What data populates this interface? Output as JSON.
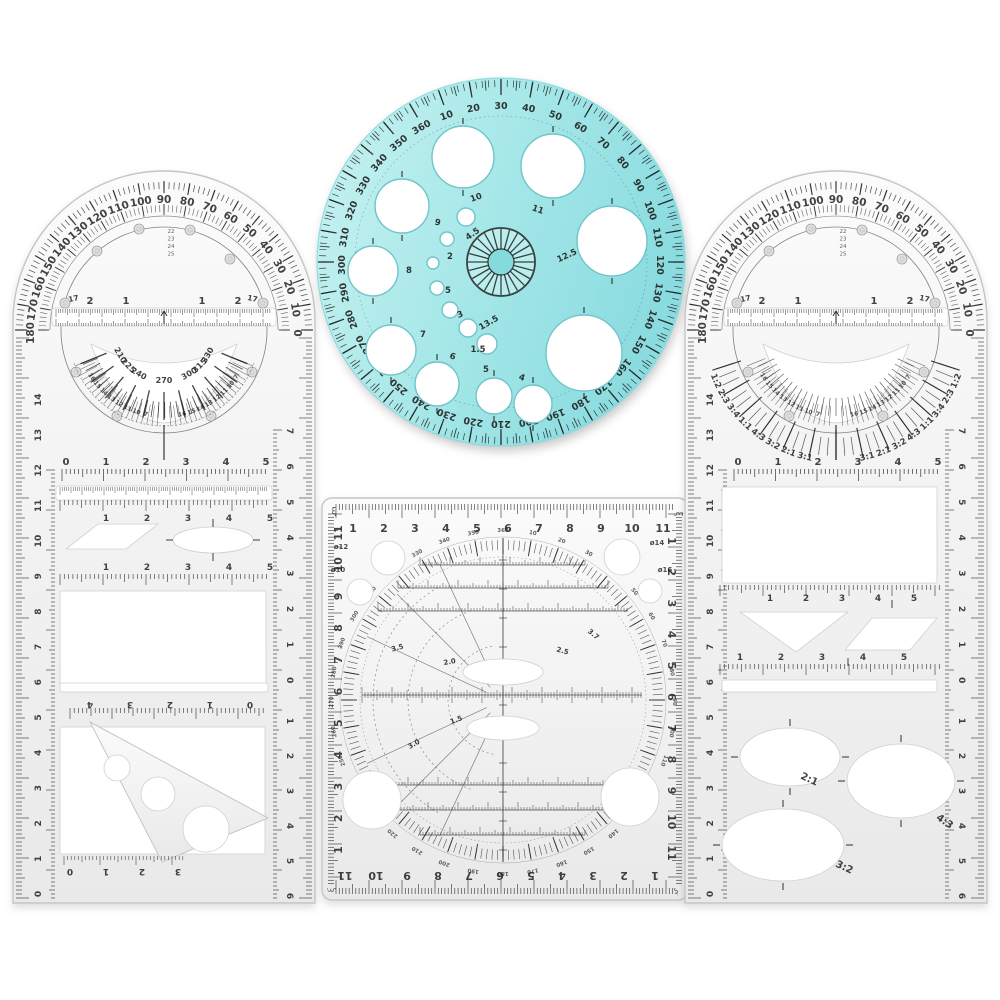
{
  "scene": {
    "background": "#ffffff",
    "type": "product-photo",
    "items": [
      "left-multifunction-ruler",
      "blue-circle-template",
      "square-protractor-template",
      "right-multifunction-ruler"
    ]
  },
  "colors": {
    "plastic_hi": "#fbfbfb",
    "plastic_mid": "#f1f1f1",
    "plastic_lo": "#e9e9e9",
    "plastic_edge": "#c5c5c5",
    "cutout": "#ffffff",
    "cutout_edge": "#d0d0d0",
    "ink": "#222222",
    "rivet_fill": "#dedede",
    "rivet_edge": "#9a9a9a",
    "teal_light": "#c9f2f1",
    "teal_mid": "#a5e7e8",
    "teal_dark": "#8bdce0",
    "teal_deep": "#7fd8dc",
    "teal_hole_edge": "#6fc5cb"
  },
  "multi_ruler": {
    "protractor_degrees": [
      "0",
      "10",
      "20",
      "30",
      "40",
      "50",
      "60",
      "70",
      "80",
      "90",
      "100",
      "110",
      "120",
      "130",
      "140",
      "150",
      "160",
      "170",
      "180"
    ],
    "slot_labels": [
      "2",
      "1",
      "1",
      "2"
    ],
    "side_labels": [
      "17",
      "17"
    ],
    "inner_stack": [
      "22",
      "23",
      "24",
      "25"
    ],
    "fan_right": [
      "7",
      "10",
      "11",
      "12",
      "13",
      "14",
      "15",
      "16"
    ],
    "fan_left": [
      "16",
      "15",
      "14",
      "13",
      "12",
      "11",
      "10",
      "7"
    ],
    "cm_row": [
      "0",
      "1",
      "2",
      "3",
      "4",
      "5"
    ],
    "half_row": [
      "1",
      "2",
      "3",
      "4",
      "5"
    ],
    "left_edge": [
      "0",
      "1",
      "2",
      "3",
      "4",
      "5",
      "6",
      "7",
      "8",
      "9",
      "10",
      "11",
      "12",
      "13",
      "14"
    ],
    "right_edge_upper": [
      "7",
      "6",
      "5",
      "4",
      "3",
      "2",
      "1",
      "0"
    ],
    "right_edge_lower": [
      "1",
      "2",
      "3",
      "4",
      "5",
      "6"
    ]
  },
  "left_ruler_extra": {
    "lower_degrees": [
      "210",
      "225",
      "240",
      "270",
      "300",
      "315",
      "330"
    ],
    "reversed_row": [
      "0",
      "1",
      "2",
      "3",
      "4"
    ],
    "triangle_row": [
      "0",
      "1",
      "2",
      "3"
    ]
  },
  "right_ruler_extra": {
    "ratio_fan": [
      "1:2",
      "2:3",
      "3:4",
      "1:1",
      "4:3",
      "3:2",
      "2:1",
      "3:1"
    ],
    "ellipse_labels": [
      "2:1",
      "4:3",
      "3:2"
    ]
  },
  "circle_template": {
    "degrees": [
      "10",
      "20",
      "30",
      "40",
      "50",
      "60",
      "70",
      "80",
      "90",
      "100",
      "110",
      "120",
      "130",
      "140",
      "150",
      "160",
      "170",
      "180",
      "190",
      "200",
      "210",
      "220",
      "230",
      "240",
      "250",
      "260",
      "270",
      "280",
      "290",
      "300",
      "310",
      "320",
      "330",
      "340",
      "350",
      "360"
    ],
    "hole_labels": [
      "10",
      "11",
      "12.5",
      "",
      "9",
      "8",
      "7",
      "6",
      "5",
      "4",
      "4.5",
      "2",
      "",
      "5",
      "3",
      "13.5",
      "1.5"
    ]
  },
  "square_template": {
    "top_scale": [
      "1",
      "2",
      "3",
      "4",
      "5",
      "6",
      "7",
      "8",
      "9",
      "10",
      "11"
    ],
    "bottom_scale": [
      "1",
      "2",
      "3",
      "4",
      "5",
      "6",
      "7",
      "8",
      "9",
      "10",
      "11"
    ],
    "left_scale": [
      "11",
      "10",
      "9",
      "8",
      "7",
      "6",
      "5",
      "4",
      "3",
      "2",
      "1"
    ],
    "right_scale": [
      "1",
      "2",
      "3",
      "4",
      "5",
      "6",
      "7",
      "8",
      "9",
      "10",
      "11"
    ],
    "ring_degrees": [
      "10",
      "20",
      "30",
      "40",
      "50",
      "60",
      "70",
      "80",
      "90",
      "100",
      "110",
      "120",
      "130",
      "140",
      "150",
      "160",
      "170",
      "180",
      "190",
      "200",
      "210",
      "220",
      "230",
      "240",
      "250",
      "260",
      "270",
      "280",
      "290",
      "300",
      "310",
      "320",
      "330",
      "340",
      "350",
      "360"
    ],
    "hole_labels": [
      "ø12",
      "ø10",
      "ø14",
      "ø16"
    ],
    "measure_labels": [
      "3.5",
      "2.0",
      "1.1",
      "1.0",
      "2.5",
      "3.7",
      "1.5",
      "3.0"
    ],
    "corner_mark": "ξ"
  }
}
